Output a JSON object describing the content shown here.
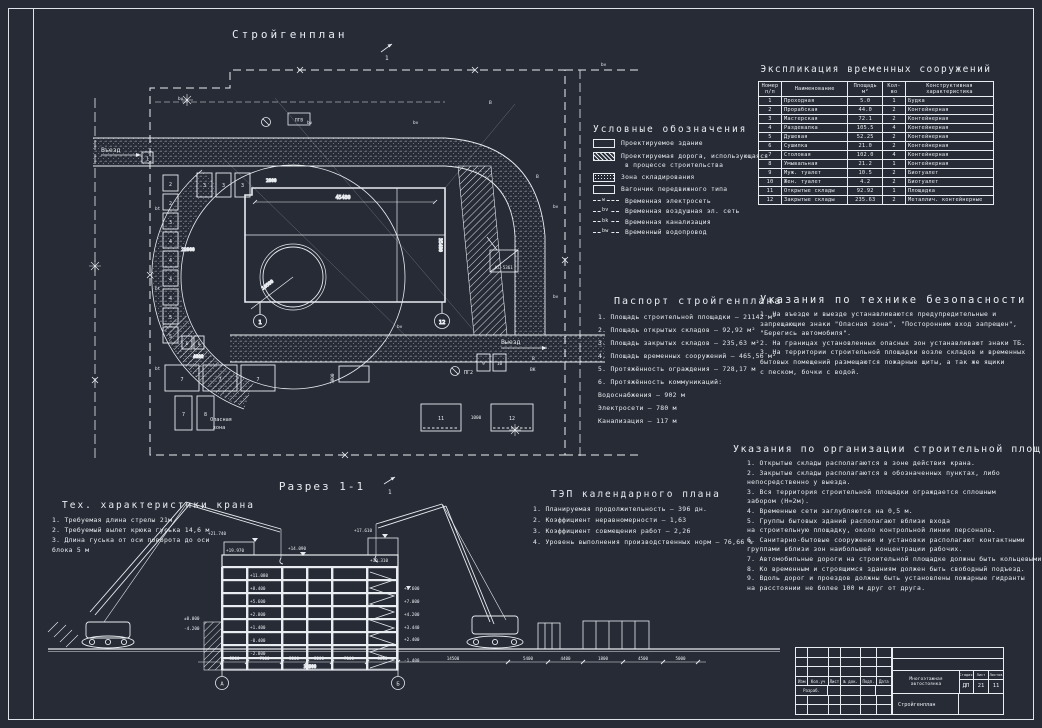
{
  "sheet": {
    "bg": "#262b35",
    "line": "#e9ecf1"
  },
  "plan": {
    "title": "Стройгенплан",
    "vezd": "Въезд",
    "vyezd": "Выезд",
    "danger": [
      "Опасная",
      "зона"
    ],
    "crane_model": "КС-5361",
    "pgv": "ПГВ",
    "pg2": "ПГ2",
    "radius": "10500",
    "sec_mark": "1",
    "dims": {
      "building_w": "45480",
      "building_h": "35480",
      "d22000": "22000",
      "d2000": "2000",
      "d1000": "1000",
      "d7000": "7000",
      "d4000": "4000"
    },
    "axes": [
      "1",
      "12"
    ],
    "gate": "1",
    "stack": [
      "2",
      "2",
      "3",
      "4",
      "4",
      "4",
      "4",
      "5",
      "5"
    ],
    "top_row": [
      "3",
      "3",
      "3"
    ],
    "wide": [
      "7",
      "7",
      "7"
    ],
    "pair": [
      "7",
      "8"
    ],
    "six": [
      "6",
      "6"
    ],
    "wc": [
      "9",
      "10"
    ],
    "storage": [
      "11",
      "12"
    ],
    "bv": [
      "bv",
      "bv",
      "bv",
      "bv",
      "bv",
      "bv",
      "bv"
    ],
    "bt": [
      "bt",
      "bt",
      "bt"
    ],
    "v_marks": [
      "В",
      "В",
      "В"
    ],
    "vk": "ВК"
  },
  "legend": {
    "title": "Условные обозначения",
    "building": "Проектируемое здание",
    "road1": "Проектируемая дорога, использующаяся",
    "road2": "в процессе строительства",
    "storage": "Зона складирования",
    "wagon": "Вагончик передвижного типа",
    "power": {
      "tag": "w",
      "label": "Временная электросеть"
    },
    "air": {
      "tag": "bv",
      "label": "Временная воздушная эл. сеть"
    },
    "sewer": {
      "tag": "bk",
      "label": "Временная канализация"
    },
    "water": {
      "tag": "bw",
      "label": "Временный водопровод"
    }
  },
  "explication": {
    "title": "Экспликация временных сооружений",
    "columns": [
      "Номер п/п",
      "Наименование",
      "Площадь м²",
      "Кол-во",
      "Конструктивная характеристика"
    ],
    "rows": [
      {
        "num": "1",
        "name": "Проходная",
        "area": "5.0",
        "qty": "1",
        "kind": "Будка"
      },
      {
        "num": "2",
        "name": "Прорабская",
        "area": "44.0",
        "qty": "2",
        "kind": "Контейнерная"
      },
      {
        "num": "3",
        "name": "Мастерская",
        "area": "72.1",
        "qty": "2",
        "kind": "Контейнерная"
      },
      {
        "num": "4",
        "name": "Раздевалка",
        "area": "105.5",
        "qty": "4",
        "kind": "Контейнерная"
      },
      {
        "num": "5",
        "name": "Душевая",
        "area": "52.25",
        "qty": "2",
        "kind": "Контейнерная"
      },
      {
        "num": "6",
        "name": "Сушилка",
        "area": "21.0",
        "qty": "2",
        "kind": "Контейнерная"
      },
      {
        "num": "7",
        "name": "Столовая",
        "area": "102.0",
        "qty": "4",
        "kind": "Контейнерная"
      },
      {
        "num": "8",
        "name": "Умывальная",
        "area": "21.2",
        "qty": "1",
        "kind": "Контейнерная"
      },
      {
        "num": "9",
        "name": "Муж. туалет",
        "area": "10.5",
        "qty": "2",
        "kind": "Биотуалет"
      },
      {
        "num": "10",
        "name": "Жен. туалет",
        "area": "4.2",
        "qty": "2",
        "kind": "Биотуалет"
      },
      {
        "num": "11",
        "name": "Открытые склады",
        "area": "92.92",
        "qty": "1",
        "kind": "Площадка"
      },
      {
        "num": "12",
        "name": "Закрытые склады",
        "area": "235.63",
        "qty": "2",
        "kind": "Металлич. контейнерные"
      }
    ]
  },
  "passport": {
    "title": "Паспорт стройгенплана",
    "lines": [
      "1. Площадь строительной площадки — 21142 м²",
      "2. Площадь открытых складов — 92,92 м²",
      "3. Площадь закрытых складов — 235,63 м²",
      "4. Площадь временных сооружений — 465,56 м²",
      "5. Протяжённость ограждения — 728,17 м",
      "6. Протяжённость коммуникаций:",
      "Водоснабжения — 902 м",
      "Электросети — 780 м",
      "Канализация — 117 м"
    ]
  },
  "safety": {
    "title": "Указания по технике безопасности",
    "lines": [
      "1. На въезде и выезде устанавливаются предупредительные и",
      "запрещающие знаки \"Опасная зона\", \"Посторонним вход запрещен\",",
      "\"Берегись автомобиля\".",
      "2. На границах установленных опасных зон устанавливают знаки ТБ.",
      "3. На территории строительной площадки возле складов и временных",
      "бытовых помещений размещаются пожарные щиты, а так же ящики",
      "с песком, бочки с водой."
    ]
  },
  "site_org": {
    "title": "Указания по организации строительной площадки",
    "lines": [
      "1. Открытые склады располагаются в зоне действия крана.",
      "2. Закрытые склады располагаются в обозначенных пунктах, либо",
      "непосредственно у выезда.",
      "3. Вся территория строительной площадки ограждается сплошным",
      "забором (Н=2м).",
      "4. Временные сети заглубляются на 0,5 м.",
      "5. Группы бытовых зданий располагают вблизи входа",
      "на строительную площадку, около контрольной линии персонала.",
      "6. Санитарно-бытовые сооружения и установки располагают контактными",
      "группами вблизи зон наибольшей концентрации рабочих.",
      "7. Автомобильные дороги на строительной площадке должны быть кольцевыми.",
      "8. Ко временным и строящимся зданиям должен быть свободный подъезд.",
      "9. Вдоль дорог и проездов должны быть установлены пожарные гидранты",
      "на расстоянии не более 100 м друг от друга."
    ]
  },
  "crane_specs": {
    "title": "Тех. характеристики крана",
    "lines": [
      "1. Требуемая длина стрелы 21м",
      "2. Требуемый вылет крюка гуська 14,6 м",
      "3. Длина гуська от оси поворота до оси",
      "блока 5 м"
    ]
  },
  "tep": {
    "title": "ТЭП календарного плана",
    "lines": [
      "1. Планируемая продолжительность — 396 дн.",
      "2. Коэффициент неравномерности — 1,63",
      "3. Коэффициент совмещения работ — 2,26",
      "4. Уровень выполнения производственных норм — 76,66 %"
    ]
  },
  "section": {
    "title": "Разрез 1-1",
    "mark": "1",
    "roof_elevs": [
      "+21.740",
      "+19.970",
      "+14.090",
      "+17.610",
      "+19.310"
    ],
    "inner_elevs": [
      "+11.080",
      "+8.400",
      "+5.600",
      "+2.800",
      "+1.400",
      "-0.400",
      "-2.800"
    ],
    "right_elevs": [
      "+8.600",
      "+7.000",
      "+4.200",
      "+3.440",
      "+2.400",
      "-1.400"
    ],
    "ground_elevs": [
      "±0.000",
      "-4.200"
    ],
    "dims": [
      "5200",
      "7100",
      "5200",
      "5200",
      "7100",
      "5200"
    ],
    "dims_right": [
      "14500",
      "5400",
      "4400",
      "1800",
      "4500",
      "5000"
    ],
    "total_dim": "34900",
    "axes": [
      "А",
      "Б"
    ]
  },
  "title_block": {
    "project": "Многоэтажная автостоянка",
    "sheet_name": "Стройгенплан",
    "stage_label": "Стадия",
    "sheet_label": "Лист",
    "sheets_label": "Листов",
    "stage": "ДП",
    "sheet_num": "21",
    "sheets_total": "11",
    "cols": [
      "Изм",
      "Кол.уч",
      "Лист",
      "№ док.",
      "Подп.",
      "Дата"
    ],
    "razrab": "Разраб."
  }
}
